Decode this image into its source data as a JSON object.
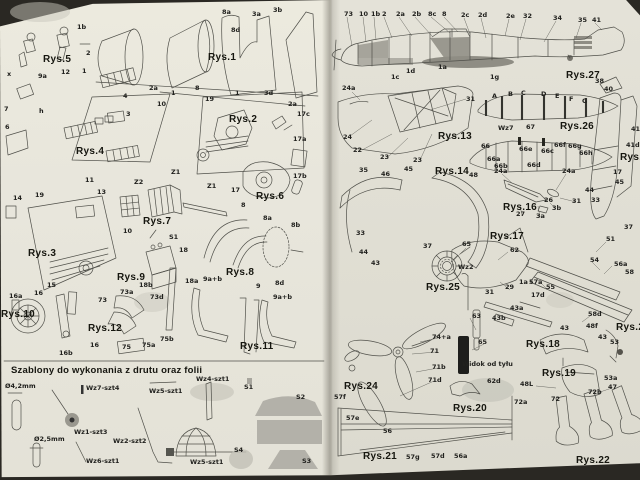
{
  "palette": {
    "paper_left": "#e8e6dc",
    "paper_right": "#e0ded3",
    "ink": "#50504a",
    "label_ink": "#21211e",
    "foil_gray": "#b3b1a9",
    "scan_edge": "#2a2823"
  },
  "left_page": {
    "figures": [
      {
        "name": "Rys.5",
        "x": 43,
        "y": 55
      },
      {
        "name": "Rys.1",
        "x": 208,
        "y": 53
      },
      {
        "name": "Rys.2",
        "x": 229,
        "y": 115
      },
      {
        "name": "Rys.4",
        "x": 76,
        "y": 147
      },
      {
        "name": "Rys.6",
        "x": 256,
        "y": 192
      },
      {
        "name": "Rys.7",
        "x": 143,
        "y": 217
      },
      {
        "name": "Rys.3",
        "x": 28,
        "y": 249
      },
      {
        "name": "Rys.9",
        "x": 117,
        "y": 273
      },
      {
        "name": "Rys.8",
        "x": 226,
        "y": 268
      },
      {
        "name": "Rys.10",
        "x": 1,
        "y": 310
      },
      {
        "name": "Rys.12",
        "x": 88,
        "y": 324
      },
      {
        "name": "Rys.11",
        "x": 240,
        "y": 342
      }
    ],
    "part_labels": [
      {
        "t": "1b",
        "x": 77,
        "y": 24
      },
      {
        "t": "2",
        "x": 86,
        "y": 50
      },
      {
        "t": "1",
        "x": 82,
        "y": 68
      },
      {
        "t": "8a",
        "x": 222,
        "y": 9
      },
      {
        "t": "8d",
        "x": 231,
        "y": 27
      },
      {
        "t": "3a",
        "x": 252,
        "y": 11
      },
      {
        "t": "3b",
        "x": 273,
        "y": 7
      },
      {
        "t": "2a",
        "x": 149,
        "y": 85
      },
      {
        "t": "1",
        "x": 171,
        "y": 90
      },
      {
        "t": "8",
        "x": 195,
        "y": 85
      },
      {
        "t": "1",
        "x": 235,
        "y": 90
      },
      {
        "t": "3d",
        "x": 264,
        "y": 90
      },
      {
        "t": "2a",
        "x": 288,
        "y": 101
      },
      {
        "t": "x",
        "x": 7,
        "y": 71
      },
      {
        "t": "9a",
        "x": 38,
        "y": 73
      },
      {
        "t": "12",
        "x": 61,
        "y": 69
      },
      {
        "t": "7",
        "x": 4,
        "y": 106
      },
      {
        "t": "6",
        "x": 5,
        "y": 124
      },
      {
        "t": "4",
        "x": 123,
        "y": 93
      },
      {
        "t": "3",
        "x": 126,
        "y": 111
      },
      {
        "t": "h",
        "x": 39,
        "y": 108
      },
      {
        "t": "10",
        "x": 157,
        "y": 101
      },
      {
        "t": "19",
        "x": 205,
        "y": 96
      },
      {
        "t": "Z1",
        "x": 171,
        "y": 169
      },
      {
        "t": "17c",
        "x": 297,
        "y": 111
      },
      {
        "t": "17a",
        "x": 293,
        "y": 136
      },
      {
        "t": "17b",
        "x": 293,
        "y": 173
      },
      {
        "t": "17",
        "x": 231,
        "y": 187
      },
      {
        "t": "Z1",
        "x": 207,
        "y": 183
      },
      {
        "t": "Z2",
        "x": 134,
        "y": 179
      },
      {
        "t": "14",
        "x": 13,
        "y": 195
      },
      {
        "t": "19",
        "x": 35,
        "y": 192
      },
      {
        "t": "13",
        "x": 97,
        "y": 189
      },
      {
        "t": "11",
        "x": 85,
        "y": 177
      },
      {
        "t": "10",
        "x": 123,
        "y": 228
      },
      {
        "t": "15",
        "x": 47,
        "y": 282
      },
      {
        "t": "S1",
        "x": 169,
        "y": 234
      },
      {
        "t": "18",
        "x": 179,
        "y": 247
      },
      {
        "t": "18b",
        "x": 139,
        "y": 282
      },
      {
        "t": "18a",
        "x": 185,
        "y": 278
      },
      {
        "t": "8",
        "x": 241,
        "y": 202
      },
      {
        "t": "8a",
        "x": 263,
        "y": 215
      },
      {
        "t": "8b",
        "x": 291,
        "y": 222
      },
      {
        "t": "8d",
        "x": 275,
        "y": 280
      },
      {
        "t": "9",
        "x": 256,
        "y": 283
      },
      {
        "t": "9a+b",
        "x": 203,
        "y": 276
      },
      {
        "t": "9a+b",
        "x": 273,
        "y": 294
      },
      {
        "t": "16a",
        "x": 9,
        "y": 293
      },
      {
        "t": "16",
        "x": 34,
        "y": 290
      },
      {
        "t": "16b",
        "x": 59,
        "y": 350
      },
      {
        "t": "16",
        "x": 90,
        "y": 342
      },
      {
        "t": "73",
        "x": 98,
        "y": 297
      },
      {
        "t": "73a",
        "x": 120,
        "y": 289
      },
      {
        "t": "73d",
        "x": 150,
        "y": 294
      },
      {
        "t": "75",
        "x": 122,
        "y": 344
      },
      {
        "t": "75a",
        "x": 142,
        "y": 342
      },
      {
        "t": "75b",
        "x": 160,
        "y": 336
      }
    ],
    "templates_section": {
      "heading": "Szablony do wykonania z drutu oraz folii",
      "labels": [
        {
          "t": "Ø4,2mm",
          "x": 5,
          "y": 383
        },
        {
          "t": "Wz7-szt4",
          "x": 86,
          "y": 385
        },
        {
          "t": "Wz5-szt1",
          "x": 149,
          "y": 388
        },
        {
          "t": "Wz4-szt1",
          "x": 196,
          "y": 376
        },
        {
          "t": "S1",
          "x": 244,
          "y": 384
        },
        {
          "t": "S2",
          "x": 296,
          "y": 394
        },
        {
          "t": "Wz1-szt3",
          "x": 74,
          "y": 429
        },
        {
          "t": "Ø2,5mm",
          "x": 34,
          "y": 436
        },
        {
          "t": "Wz2-szt2",
          "x": 113,
          "y": 438
        },
        {
          "t": "Wz6-szt1",
          "x": 86,
          "y": 458
        },
        {
          "t": "Wz5-szt1",
          "x": 190,
          "y": 459
        },
        {
          "t": "S4",
          "x": 234,
          "y": 447
        },
        {
          "t": "S3",
          "x": 302,
          "y": 458
        }
      ]
    }
  },
  "right_page": {
    "figures": [
      {
        "name": "Rys.27",
        "x": 566,
        "y": 71
      },
      {
        "name": "Rys.13",
        "x": 438,
        "y": 132
      },
      {
        "name": "Rys.26",
        "x": 560,
        "y": 122
      },
      {
        "name": "Rys.14",
        "x": 435,
        "y": 167
      },
      {
        "name": "Rys.16",
        "x": 503,
        "y": 203
      },
      {
        "name": "Rys.15",
        "x": 620,
        "y": 153
      },
      {
        "name": "Rys.17",
        "x": 490,
        "y": 232
      },
      {
        "name": "Rys.25",
        "x": 426,
        "y": 283
      },
      {
        "name": "Rys.18",
        "x": 526,
        "y": 340
      },
      {
        "name": "Rys.19",
        "x": 542,
        "y": 369
      },
      {
        "name": "Rys.23",
        "x": 616,
        "y": 323
      },
      {
        "name": "Rys.24",
        "x": 344,
        "y": 382
      },
      {
        "name": "Rys.20",
        "x": 453,
        "y": 404
      },
      {
        "name": "Rys.21",
        "x": 363,
        "y": 452
      },
      {
        "name": "Rys.22",
        "x": 576,
        "y": 456
      }
    ],
    "part_labels": [
      {
        "t": "73",
        "x": 344,
        "y": 11
      },
      {
        "t": "10",
        "x": 359,
        "y": 11
      },
      {
        "t": "1b",
        "x": 371,
        "y": 11
      },
      {
        "t": "2",
        "x": 382,
        "y": 11
      },
      {
        "t": "2a",
        "x": 396,
        "y": 11
      },
      {
        "t": "2b",
        "x": 412,
        "y": 11
      },
      {
        "t": "8c",
        "x": 428,
        "y": 11
      },
      {
        "t": "8",
        "x": 442,
        "y": 11
      },
      {
        "t": "2c",
        "x": 461,
        "y": 12
      },
      {
        "t": "2d",
        "x": 478,
        "y": 12
      },
      {
        "t": "2e",
        "x": 506,
        "y": 13
      },
      {
        "t": "32",
        "x": 523,
        "y": 13
      },
      {
        "t": "34",
        "x": 553,
        "y": 15
      },
      {
        "t": "35",
        "x": 578,
        "y": 17
      },
      {
        "t": "41",
        "x": 592,
        "y": 17
      },
      {
        "t": "24a",
        "x": 342,
        "y": 85
      },
      {
        "t": "1c",
        "x": 391,
        "y": 74
      },
      {
        "t": "1d",
        "x": 406,
        "y": 68
      },
      {
        "t": "1a",
        "x": 438,
        "y": 64
      },
      {
        "t": "1g",
        "x": 490,
        "y": 74
      },
      {
        "t": "38",
        "x": 595,
        "y": 78
      },
      {
        "t": "31",
        "x": 466,
        "y": 96
      },
      {
        "t": "24",
        "x": 343,
        "y": 134
      },
      {
        "t": "22",
        "x": 353,
        "y": 147
      },
      {
        "t": "23",
        "x": 380,
        "y": 154
      },
      {
        "t": "23",
        "x": 413,
        "y": 157
      },
      {
        "t": "A",
        "x": 492,
        "y": 93
      },
      {
        "t": "B",
        "x": 508,
        "y": 91
      },
      {
        "t": "C",
        "x": 521,
        "y": 90
      },
      {
        "t": "D",
        "x": 541,
        "y": 91
      },
      {
        "t": "E",
        "x": 555,
        "y": 93
      },
      {
        "t": "F",
        "x": 569,
        "y": 96
      },
      {
        "t": "G",
        "x": 582,
        "y": 98
      },
      {
        "t": "Wz7",
        "x": 498,
        "y": 125
      },
      {
        "t": "67",
        "x": 526,
        "y": 124
      },
      {
        "t": "66",
        "x": 481,
        "y": 143
      },
      {
        "t": "66a",
        "x": 487,
        "y": 156
      },
      {
        "t": "66b",
        "x": 494,
        "y": 163
      },
      {
        "t": "66e",
        "x": 519,
        "y": 146
      },
      {
        "t": "66d",
        "x": 527,
        "y": 162
      },
      {
        "t": "66c",
        "x": 541,
        "y": 148
      },
      {
        "t": "66f",
        "x": 554,
        "y": 142
      },
      {
        "t": "66g",
        "x": 568,
        "y": 143
      },
      {
        "t": "66h",
        "x": 579,
        "y": 150
      },
      {
        "t": "35",
        "x": 359,
        "y": 167
      },
      {
        "t": "46",
        "x": 381,
        "y": 171
      },
      {
        "t": "45",
        "x": 404,
        "y": 166
      },
      {
        "t": "48",
        "x": 469,
        "y": 172
      },
      {
        "t": "33",
        "x": 356,
        "y": 230
      },
      {
        "t": "44",
        "x": 359,
        "y": 249
      },
      {
        "t": "43",
        "x": 371,
        "y": 260
      },
      {
        "t": "37",
        "x": 423,
        "y": 243
      },
      {
        "t": "24a",
        "x": 494,
        "y": 168
      },
      {
        "t": "24a",
        "x": 562,
        "y": 168
      },
      {
        "t": "26",
        "x": 544,
        "y": 197
      },
      {
        "t": "27",
        "x": 516,
        "y": 211
      },
      {
        "t": "3a",
        "x": 536,
        "y": 213
      },
      {
        "t": "3b",
        "x": 552,
        "y": 205
      },
      {
        "t": "31",
        "x": 572,
        "y": 198
      },
      {
        "t": "33",
        "x": 591,
        "y": 197
      },
      {
        "t": "44",
        "x": 585,
        "y": 187
      },
      {
        "t": "45",
        "x": 615,
        "y": 179
      },
      {
        "t": "40",
        "x": 604,
        "y": 86
      },
      {
        "t": "41",
        "x": 631,
        "y": 126
      },
      {
        "t": "41d",
        "x": 626,
        "y": 142
      },
      {
        "t": "17",
        "x": 613,
        "y": 169
      },
      {
        "t": "37",
        "x": 624,
        "y": 224
      },
      {
        "t": "65",
        "x": 462,
        "y": 241
      },
      {
        "t": "Wz2",
        "x": 458,
        "y": 264
      },
      {
        "t": "63",
        "x": 472,
        "y": 313
      },
      {
        "t": "65",
        "x": 478,
        "y": 339
      },
      {
        "t": "62",
        "x": 510,
        "y": 247
      },
      {
        "t": "29",
        "x": 505,
        "y": 284
      },
      {
        "t": "1a",
        "x": 519,
        "y": 279
      },
      {
        "t": "57a",
        "x": 529,
        "y": 279
      },
      {
        "t": "55",
        "x": 546,
        "y": 284
      },
      {
        "t": "31",
        "x": 485,
        "y": 289
      },
      {
        "t": "17d",
        "x": 531,
        "y": 292
      },
      {
        "t": "51",
        "x": 606,
        "y": 236
      },
      {
        "t": "54",
        "x": 590,
        "y": 257
      },
      {
        "t": "56a",
        "x": 614,
        "y": 261
      },
      {
        "t": "58",
        "x": 625,
        "y": 269
      },
      {
        "t": "58d",
        "x": 588,
        "y": 311
      },
      {
        "t": "48f",
        "x": 586,
        "y": 323
      },
      {
        "t": "43",
        "x": 560,
        "y": 325
      },
      {
        "t": "43a",
        "x": 510,
        "y": 305
      },
      {
        "t": "43b",
        "x": 492,
        "y": 315
      },
      {
        "t": "43",
        "x": 598,
        "y": 334
      },
      {
        "t": "53",
        "x": 610,
        "y": 339
      },
      {
        "t": "53a",
        "x": 604,
        "y": 375
      },
      {
        "t": "48L",
        "x": 520,
        "y": 381
      },
      {
        "t": "47",
        "x": 608,
        "y": 384
      },
      {
        "t": "74+a",
        "x": 432,
        "y": 334
      },
      {
        "t": "71",
        "x": 430,
        "y": 348
      },
      {
        "t": "71b",
        "x": 432,
        "y": 364
      },
      {
        "t": "71d",
        "x": 428,
        "y": 377
      },
      {
        "t": "62d",
        "x": 487,
        "y": 378
      },
      {
        "t": "57f",
        "x": 334,
        "y": 394
      },
      {
        "t": "57e",
        "x": 346,
        "y": 415
      },
      {
        "t": "56",
        "x": 383,
        "y": 428
      },
      {
        "t": "57g",
        "x": 406,
        "y": 454
      },
      {
        "t": "57d",
        "x": 431,
        "y": 453
      },
      {
        "t": "56a",
        "x": 454,
        "y": 453
      },
      {
        "t": "72a",
        "x": 514,
        "y": 399
      },
      {
        "t": "72",
        "x": 551,
        "y": 396
      },
      {
        "t": "72b",
        "x": 588,
        "y": 389
      }
    ],
    "notes": [
      {
        "t": "Widok od tyłu",
        "x": 462,
        "y": 361
      }
    ]
  }
}
